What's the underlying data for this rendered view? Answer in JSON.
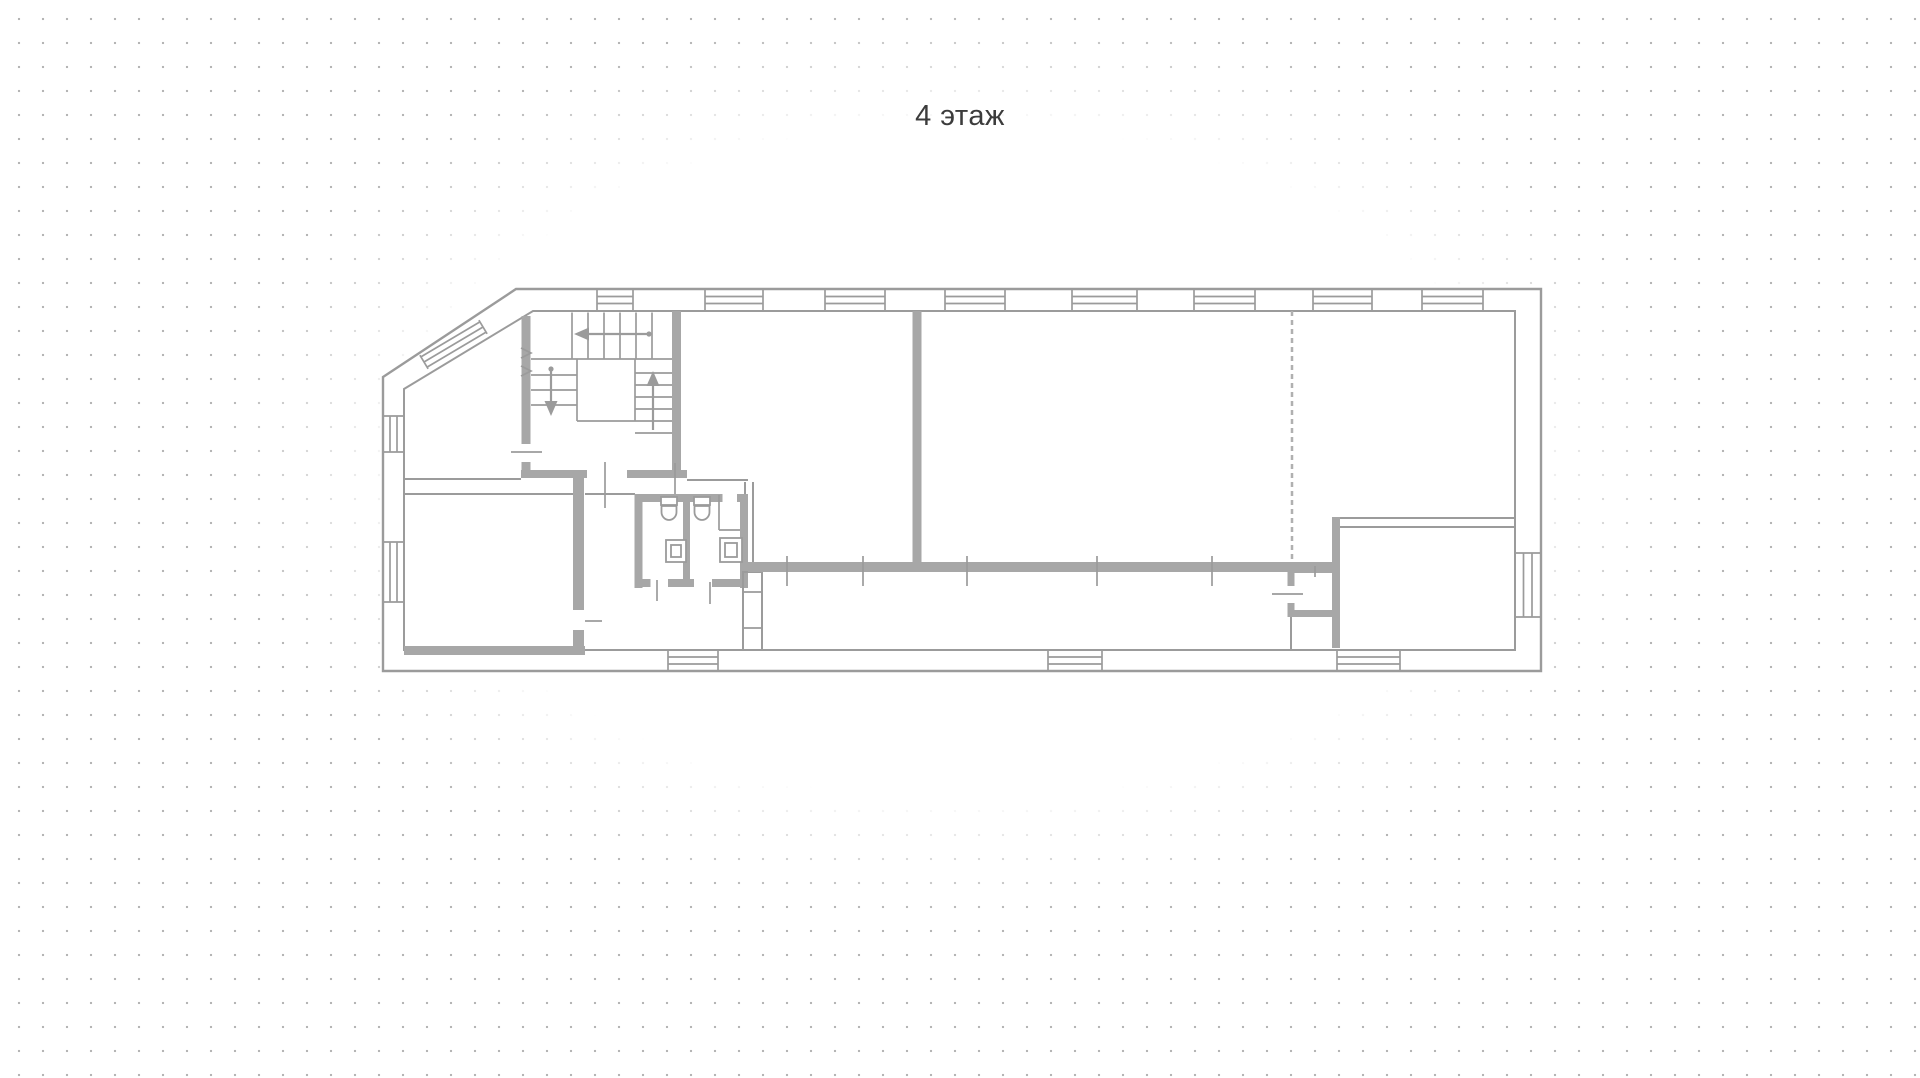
{
  "title": "4 этаж",
  "floor": {
    "number": "4",
    "label": "4 этаж"
  },
  "colors": {
    "background": "#ffffff",
    "dot_grid": "#b5b5b5",
    "wall_stroke": "#9b9b9b",
    "wall_fill": "#a7a7a7",
    "dashed_wall": "#b0b0b0",
    "title_text": "#3c3c3c"
  },
  "plan": {
    "window_counts": {
      "top_wall": 8,
      "left_wall": 2,
      "right_wall": 1,
      "bottom_wall": 3,
      "diagonal_wall": 1
    },
    "stair_arrows": [
      "left",
      "down",
      "up"
    ],
    "bathroom_fixtures": {
      "toilets": 2,
      "sinks": 2
    }
  }
}
